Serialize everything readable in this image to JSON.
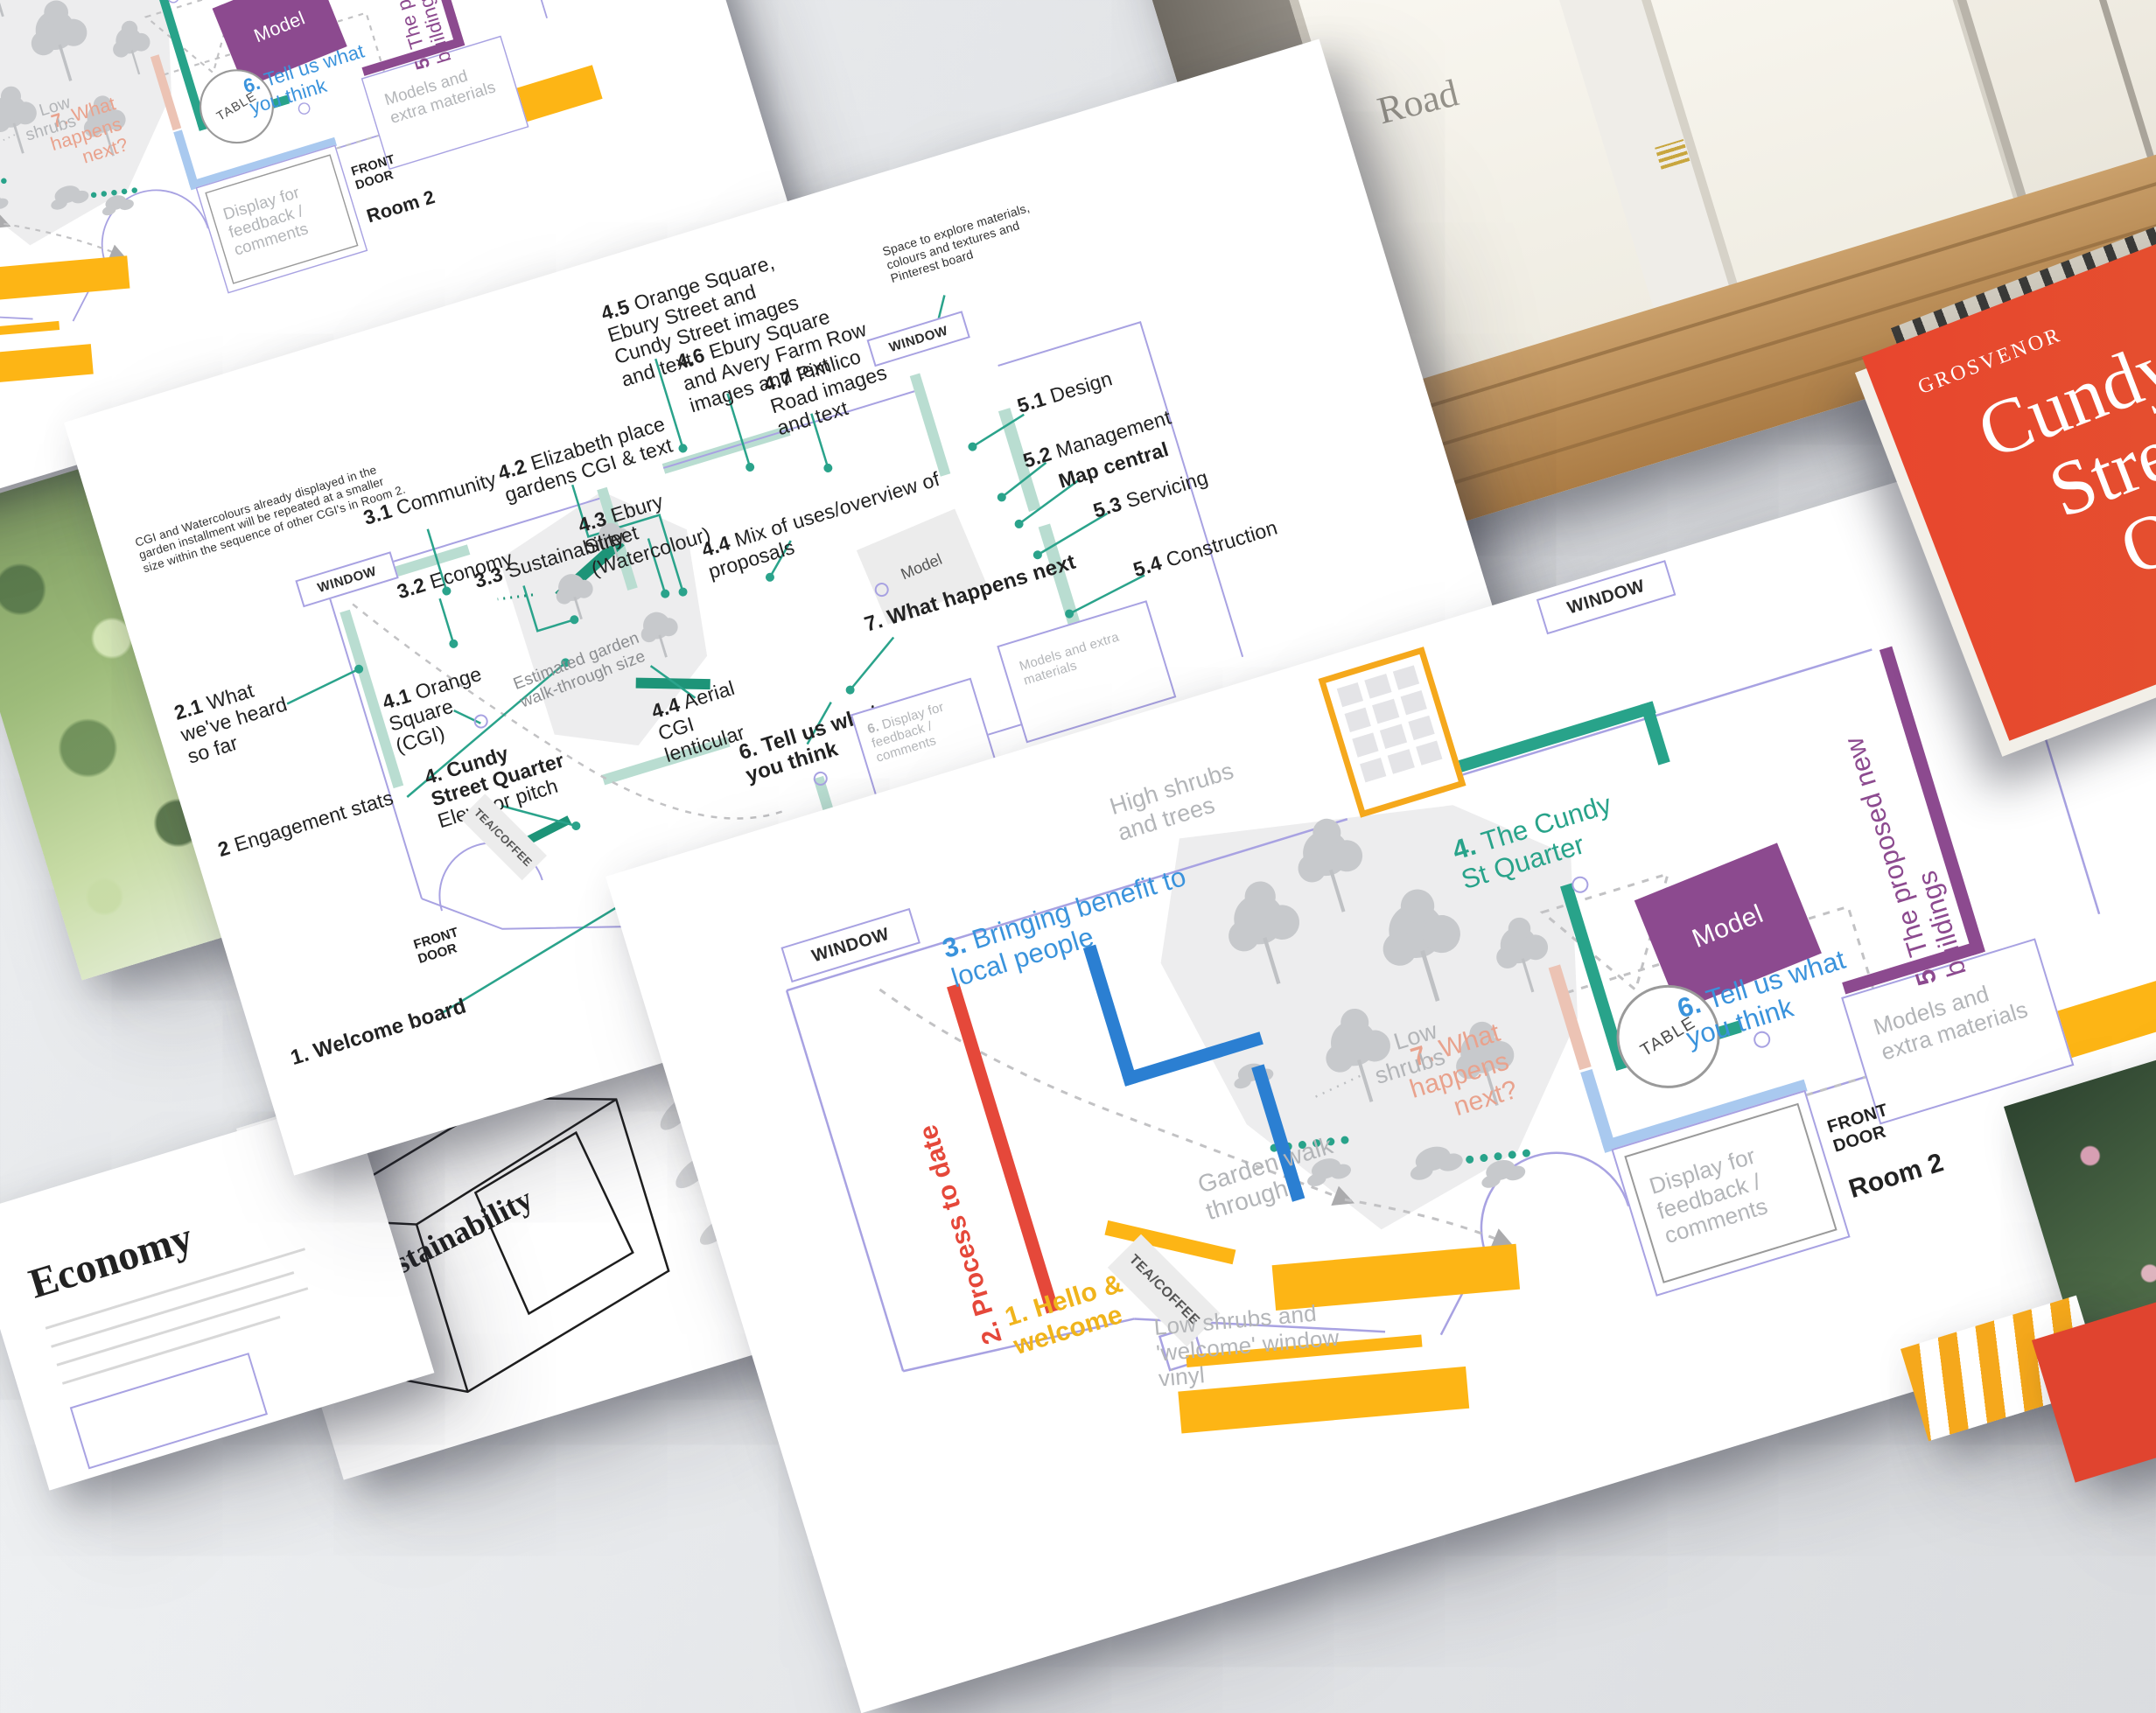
{
  "room2_plan": {
    "window_top": "WINDOW",
    "window_left": "WINDOW",
    "labels": {
      "hello": {
        "n": "1.",
        "t": "Hello & welcome"
      },
      "process": {
        "n": "2.",
        "t": "Process to date"
      },
      "benefit": {
        "n": "3.",
        "t": "Bringing benefit to local people"
      },
      "cundy": {
        "n": "4.",
        "t": "The Cundy St Quarter"
      },
      "proposed": {
        "n": "5.",
        "t": "The proposed new buildings"
      },
      "tell": {
        "n": "6.",
        "t": "Tell us what you think"
      },
      "next": {
        "n": "7.",
        "t": "What happens next?"
      }
    },
    "model": "Model",
    "table": "TABLE",
    "models_extra": "Models and extra materials",
    "display_feedback": "Display for feedback / comments",
    "front_door": "FRONT DOOR",
    "room_name": "Room 2",
    "notes": {
      "high_shrubs": "High shrubs and trees",
      "low_shrubs": "Low shrubs",
      "garden_walk": "Garden walk through",
      "welcome_vinyl": "Low shrubs and 'welcome' window vinyl",
      "tea": "TEA/COFFEE"
    }
  },
  "room1_plan": {
    "note": "CGI and Watercolours already displayed in the garden installment will be repeated at a smaller size within the sequence of other CGI's in Room 2.",
    "space_note": "Space to explore materials, colours and textures and Pinterest board",
    "window_top": "WINDOW",
    "window_left": "WINDOW",
    "front_door": "FRONT DOOR",
    "tea": "TEA/COFFEE",
    "model": "Model",
    "est_garden": "Estimated garden walk-through size",
    "models_extra": "Models and extra materials",
    "labels": {
      "welcome": {
        "n": "1.",
        "t": "Welcome board"
      },
      "heard": {
        "n": "2.1",
        "t": "What we've heard so far"
      },
      "engagement": {
        "n": "2",
        "t": "Engagement stats"
      },
      "community": {
        "n": "3.1",
        "t": "Community"
      },
      "economy": {
        "n": "3.2",
        "t": "Economy"
      },
      "sustainability": {
        "n": "3.3",
        "t": "Sustainability"
      },
      "orange_square": {
        "n": "4.1",
        "t": "Orange Square (CGI)"
      },
      "cundy": {
        "n": "4.",
        "t": "Cundy Street Quarter"
      },
      "cundy_sub": "Elevator pitch",
      "elizabeth": {
        "n": "4.2",
        "t": "Elizabeth place gardens CGI & text"
      },
      "ebury_street": {
        "n": "4.3",
        "t": "Ebury Street (Watercolour)"
      },
      "aerial": {
        "n": "4.4",
        "t": "Aerial CGI lenticular"
      },
      "mix_uses": {
        "n": "4.4",
        "t": "Mix of uses/overview of proposals"
      },
      "orange_ebury_cundy": {
        "n": "4.5",
        "t": "Orange Square, Ebury Street and Cundy Street images and text"
      },
      "ebury_avery": {
        "n": "4.6",
        "t": "Ebury Square and Avery Farm Row images and text"
      },
      "pimlico": {
        "n": "4.7",
        "t": "Pimlico Road images and text"
      },
      "design": {
        "n": "5.1",
        "t": "Design"
      },
      "management": {
        "n": "5.2",
        "t": "Management"
      },
      "map_central": "Map central",
      "servicing": {
        "n": "5.3",
        "t": "Servicing"
      },
      "construction": {
        "n": "5.4",
        "t": "Construction"
      },
      "what_next": {
        "n": "7.",
        "t": "What happens next"
      },
      "tell": {
        "n": "6.",
        "t": "Tell us what you think"
      },
      "display_feedback": {
        "n": "6.",
        "t": "Display for feedback / comments"
      }
    }
  },
  "room1_under": {
    "room_name": "Room 1"
  },
  "book": {
    "brand": "GROSVENOR",
    "title": [
      "Cundy",
      "Street",
      "Quar"
    ],
    "subtitle": "con"
  },
  "booklets": {
    "economy": "Economy",
    "sustainability": "Sustainability"
  },
  "photo": {
    "window_text": "Road"
  }
}
